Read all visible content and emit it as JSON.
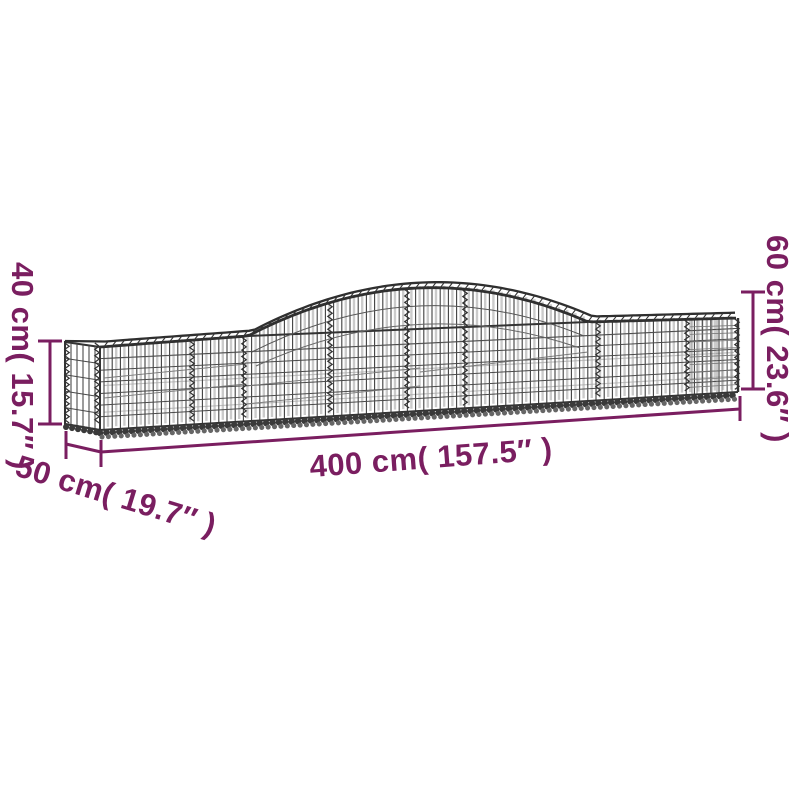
{
  "page": {
    "background": "#ffffff"
  },
  "colors": {
    "dimension": "#7A1E60",
    "wire_dark": "#3a3a3a",
    "wire_mid": "#555555",
    "wire_light": "#aaaaaa"
  },
  "illustration": {
    "semantic": "arched-gabion-wire-mesh-basket-illustration"
  },
  "dimensions": {
    "length": {
      "label": "400 cm( 157.5″ )",
      "cm": "400",
      "inches": "157.5"
    },
    "depth": {
      "label": "50 cm( 19.7″ )",
      "cm": "50",
      "inches": "19.7"
    },
    "height_end": {
      "label": "40 cm( 15.7″ )",
      "cm": "40",
      "inches": "15.7"
    },
    "height_peak": {
      "label": "60 cm( 23.6″ )",
      "cm": "60",
      "inches": "23.6"
    }
  }
}
